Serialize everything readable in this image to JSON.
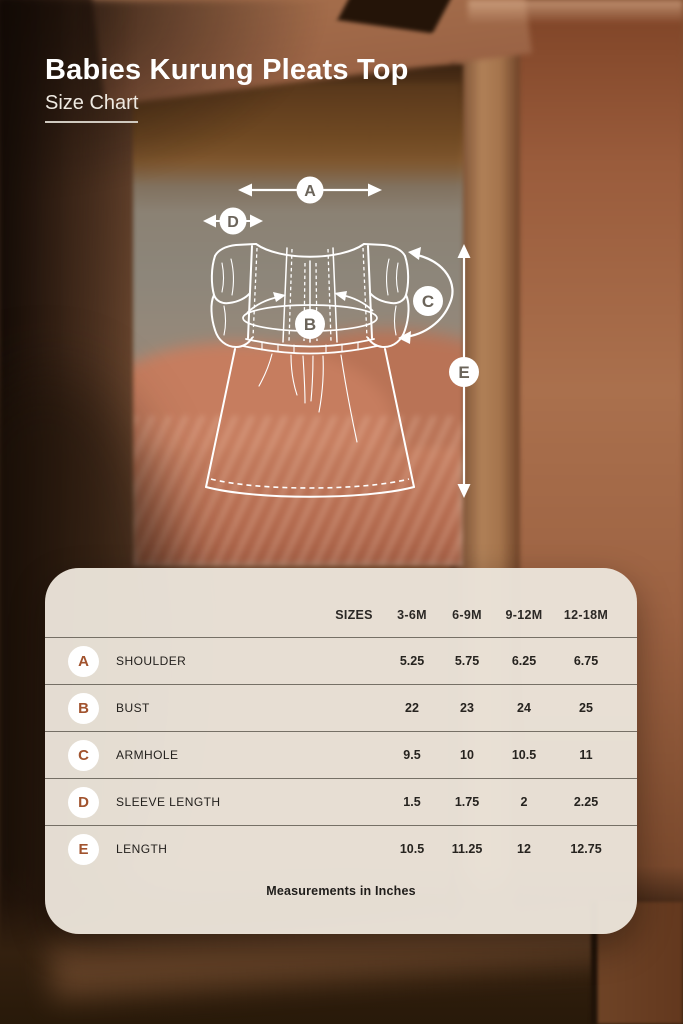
{
  "header": {
    "title": "Babies Kurung Pleats Top",
    "subtitle": "Size Chart"
  },
  "diagram": {
    "markers": [
      {
        "letter": "A"
      },
      {
        "letter": "B"
      },
      {
        "letter": "C"
      },
      {
        "letter": "D"
      },
      {
        "letter": "E"
      }
    ]
  },
  "table": {
    "sizes_label": "SIZES",
    "columns": [
      "3-6M",
      "6-9M",
      "9-12M",
      "12-18M"
    ],
    "rows": [
      {
        "letter": "A",
        "label": "SHOULDER",
        "values": [
          "5.25",
          "5.75",
          "6.25",
          "6.75"
        ]
      },
      {
        "letter": "B",
        "label": "BUST",
        "values": [
          "22",
          "23",
          "24",
          "25"
        ]
      },
      {
        "letter": "C",
        "label": "ARMHOLE",
        "values": [
          "9.5",
          "10",
          "10.5",
          "11"
        ]
      },
      {
        "letter": "D",
        "label": "SLEEVE LENGTH",
        "values": [
          "1.5",
          "1.75",
          "2",
          "2.25"
        ]
      },
      {
        "letter": "E",
        "label": "LENGTH",
        "values": [
          "10.5",
          "11.25",
          "12",
          "12.75"
        ]
      }
    ],
    "footnote": "Measurements in Inches"
  },
  "colors": {
    "accent_rust": "#a1532e",
    "panel_bg": "#eae3d9",
    "divider": "#7b766c",
    "text_dark": "#2b2825",
    "diagram_stroke": "#ffffff",
    "diagram_letter": "#6b645a"
  }
}
